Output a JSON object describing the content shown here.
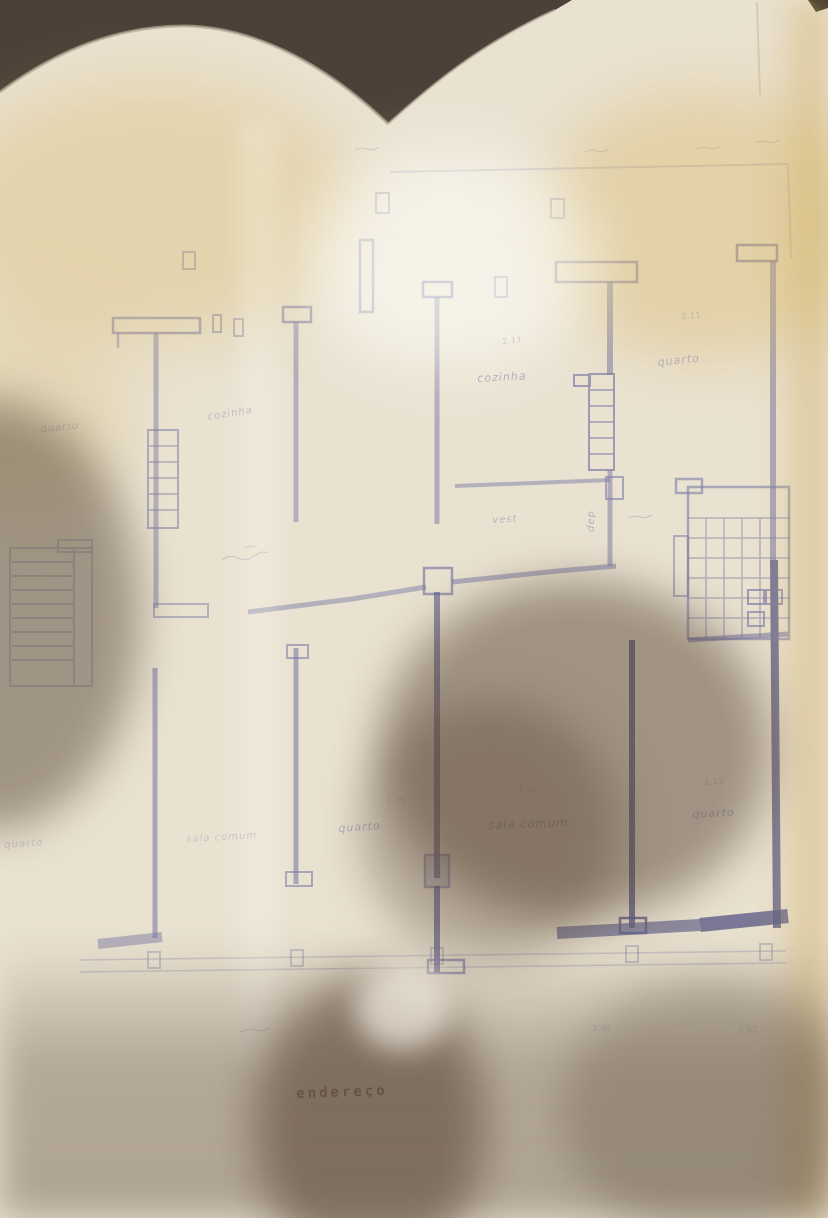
{
  "photo": {
    "description": "photographed architectural floor plan sheet, yellowed paper, curled top edge, large hand/head shadow over lower half",
    "background_color": "#4b4138",
    "paper_color": "#eae2d1",
    "ink_color": "#7d7da6",
    "dark_wall_color": "#5f5f88",
    "yellow_stain_color": "#d8b96a",
    "shadow_color": "#5a4634",
    "stamp_text_color": "#6e5f50"
  },
  "plan": {
    "title_text": "endereço",
    "room_names": [
      "cozinha",
      "quarto",
      "vest",
      "dep",
      "sala comum"
    ],
    "labels": [
      {
        "kind": "room",
        "text": "cozinha",
        "x": 477,
        "y": 372,
        "rot": -3,
        "size": 11,
        "op": 0.55
      },
      {
        "kind": "room",
        "text": "quarto",
        "x": 657,
        "y": 356,
        "rot": -6,
        "size": 11,
        "op": 0.5
      },
      {
        "kind": "room",
        "text": "cozinha",
        "x": 207,
        "y": 412,
        "rot": -9,
        "size": 10,
        "op": 0.4
      },
      {
        "kind": "room",
        "text": "quarto",
        "x": 40,
        "y": 424,
        "rot": -5,
        "size": 10,
        "op": 0.35
      },
      {
        "kind": "room",
        "text": "vest",
        "x": 492,
        "y": 515,
        "rot": -3,
        "size": 10,
        "op": 0.45
      },
      {
        "kind": "room",
        "text": "dep",
        "x": 586,
        "y": 532,
        "rot": -90,
        "size": 10,
        "op": 0.5
      },
      {
        "kind": "room",
        "text": "sala comum",
        "x": 488,
        "y": 818,
        "rot": -2,
        "size": 11.5,
        "op": 0.6
      },
      {
        "kind": "room",
        "text": "quarto",
        "x": 338,
        "y": 822,
        "rot": -4,
        "size": 11,
        "op": 0.5
      },
      {
        "kind": "room",
        "text": "quarto",
        "x": 692,
        "y": 808,
        "rot": -3,
        "size": 11,
        "op": 0.55
      },
      {
        "kind": "room",
        "text": "sala comum",
        "x": 186,
        "y": 834,
        "rot": -3,
        "size": 10,
        "op": 0.3
      },
      {
        "kind": "room",
        "text": "quarto",
        "x": 4,
        "y": 840,
        "rot": -4,
        "size": 10,
        "op": 0.3
      },
      {
        "kind": "dim",
        "text": "2.45",
        "x": 518,
        "y": 786,
        "rot": -4,
        "size": 8,
        "op": 0.4
      },
      {
        "kind": "dim",
        "text": "2.25",
        "x": 386,
        "y": 797,
        "rot": -4,
        "size": 8,
        "op": 0.35
      },
      {
        "kind": "dim",
        "text": "2.13",
        "x": 704,
        "y": 778,
        "rot": -4,
        "size": 8,
        "op": 0.4
      },
      {
        "kind": "dim",
        "text": "2.11",
        "x": 681,
        "y": 312,
        "rot": -4,
        "size": 8,
        "op": 0.4
      },
      {
        "kind": "dim",
        "text": "2.17",
        "x": 502,
        "y": 337,
        "rot": -4,
        "size": 8,
        "op": 0.35
      },
      {
        "kind": "dim",
        "text": "3.02",
        "x": 592,
        "y": 1024,
        "rot": -3,
        "size": 8,
        "op": 0.3
      },
      {
        "kind": "dim",
        "text": "2.82",
        "x": 738,
        "y": 1026,
        "rot": -3,
        "size": 8,
        "op": 0.3
      },
      {
        "kind": "stamp",
        "text": "endereço",
        "x": 296,
        "y": 1086,
        "rot": -2,
        "size": 14,
        "op": 0.8
      }
    ]
  }
}
